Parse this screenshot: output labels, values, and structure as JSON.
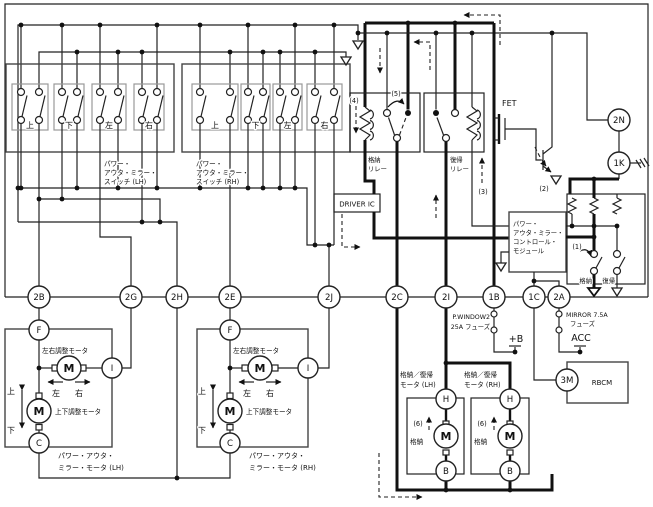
{
  "labels": {
    "fet": "FET",
    "driver_ic": "DRIVER IC",
    "rbcm": "RBCM",
    "plus_b": "+B",
    "acc": "ACC",
    "ann": {
      "a1": "(1)",
      "a2": "(2)",
      "a3": "(3)",
      "a4": "(4)",
      "a5": "(5)",
      "a6": "(6)"
    },
    "dirs": {
      "up": "上",
      "down": "下",
      "left": "左",
      "right": "右"
    },
    "relays": {
      "store1": "格納",
      "store2": "リレー",
      "return1": "復帰",
      "return2": "リレー"
    },
    "module": {
      "l1": "パワー・",
      "l2": "アウタ・ミラー・",
      "l3": "コントロール・",
      "l4": "モジュール"
    },
    "module_switches": {
      "store": "格納",
      "ret": "復帰"
    },
    "fuses": {
      "pw1": "P.WINDOW2",
      "pw2": "25A フューズ",
      "mr1": "MIRROR 7.5A",
      "mr2": "フューズ"
    },
    "switch_asm": {
      "l1": "パワー・",
      "l2": "アウタ・ミラー・",
      "lh3": "スイッチ (LH)",
      "rh3": "スイッチ (RH)"
    },
    "mirror_motor": {
      "adj_lr": "左右調整モータ",
      "adj_ud": "上下調整モータ",
      "lh1": "パワー・アウタ・",
      "lh2": "ミラー・モータ (LH)",
      "rh1": "パワー・アウタ・",
      "rh2": "ミラー・モータ (RH)"
    },
    "retract_motor": {
      "t1": "格納／復帰",
      "lh2": "モータ (LH)",
      "rh2": "モータ (RH)",
      "store": "格納"
    }
  },
  "connectors": {
    "b2": "2B",
    "g2": "2G",
    "h2": "2H",
    "e2": "2E",
    "j2": "2J",
    "c2": "2C",
    "i2": "2I",
    "b1": "1B",
    "c1": "1C",
    "a2": "2A",
    "n2": "2N",
    "k1": "1K",
    "m3": "3M"
  },
  "terminals": {
    "f": "F",
    "i": "I",
    "c": "C",
    "m": "M",
    "h": "H",
    "b": "B"
  }
}
